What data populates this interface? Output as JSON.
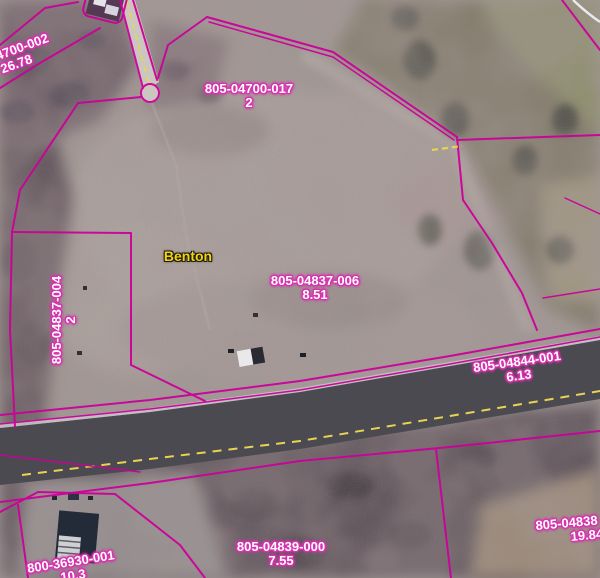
{
  "map": {
    "place_label": "Benton",
    "colors": {
      "parcel_line": "#cc0099",
      "parcel_label_text": "#ffffff",
      "parcel_label_halo": "#d832ae",
      "place_label_text": "#f2d410",
      "road_centerline": "#e8d352"
    },
    "parcel_labels": [
      {
        "id": "4700-002",
        "area": "26.78"
      },
      {
        "id": "805-04700-017",
        "area": "2"
      },
      {
        "id": "805-04837-004",
        "area": "2"
      },
      {
        "id": "805-04837-006",
        "area": "8.51"
      },
      {
        "id": "805-04844-001",
        "area": "6.13"
      },
      {
        "id": "805-04839-000",
        "area": "7.55"
      },
      {
        "id": "805-04838",
        "area": "19.84"
      },
      {
        "id": "800-36930-001",
        "area": "10.3"
      }
    ]
  }
}
